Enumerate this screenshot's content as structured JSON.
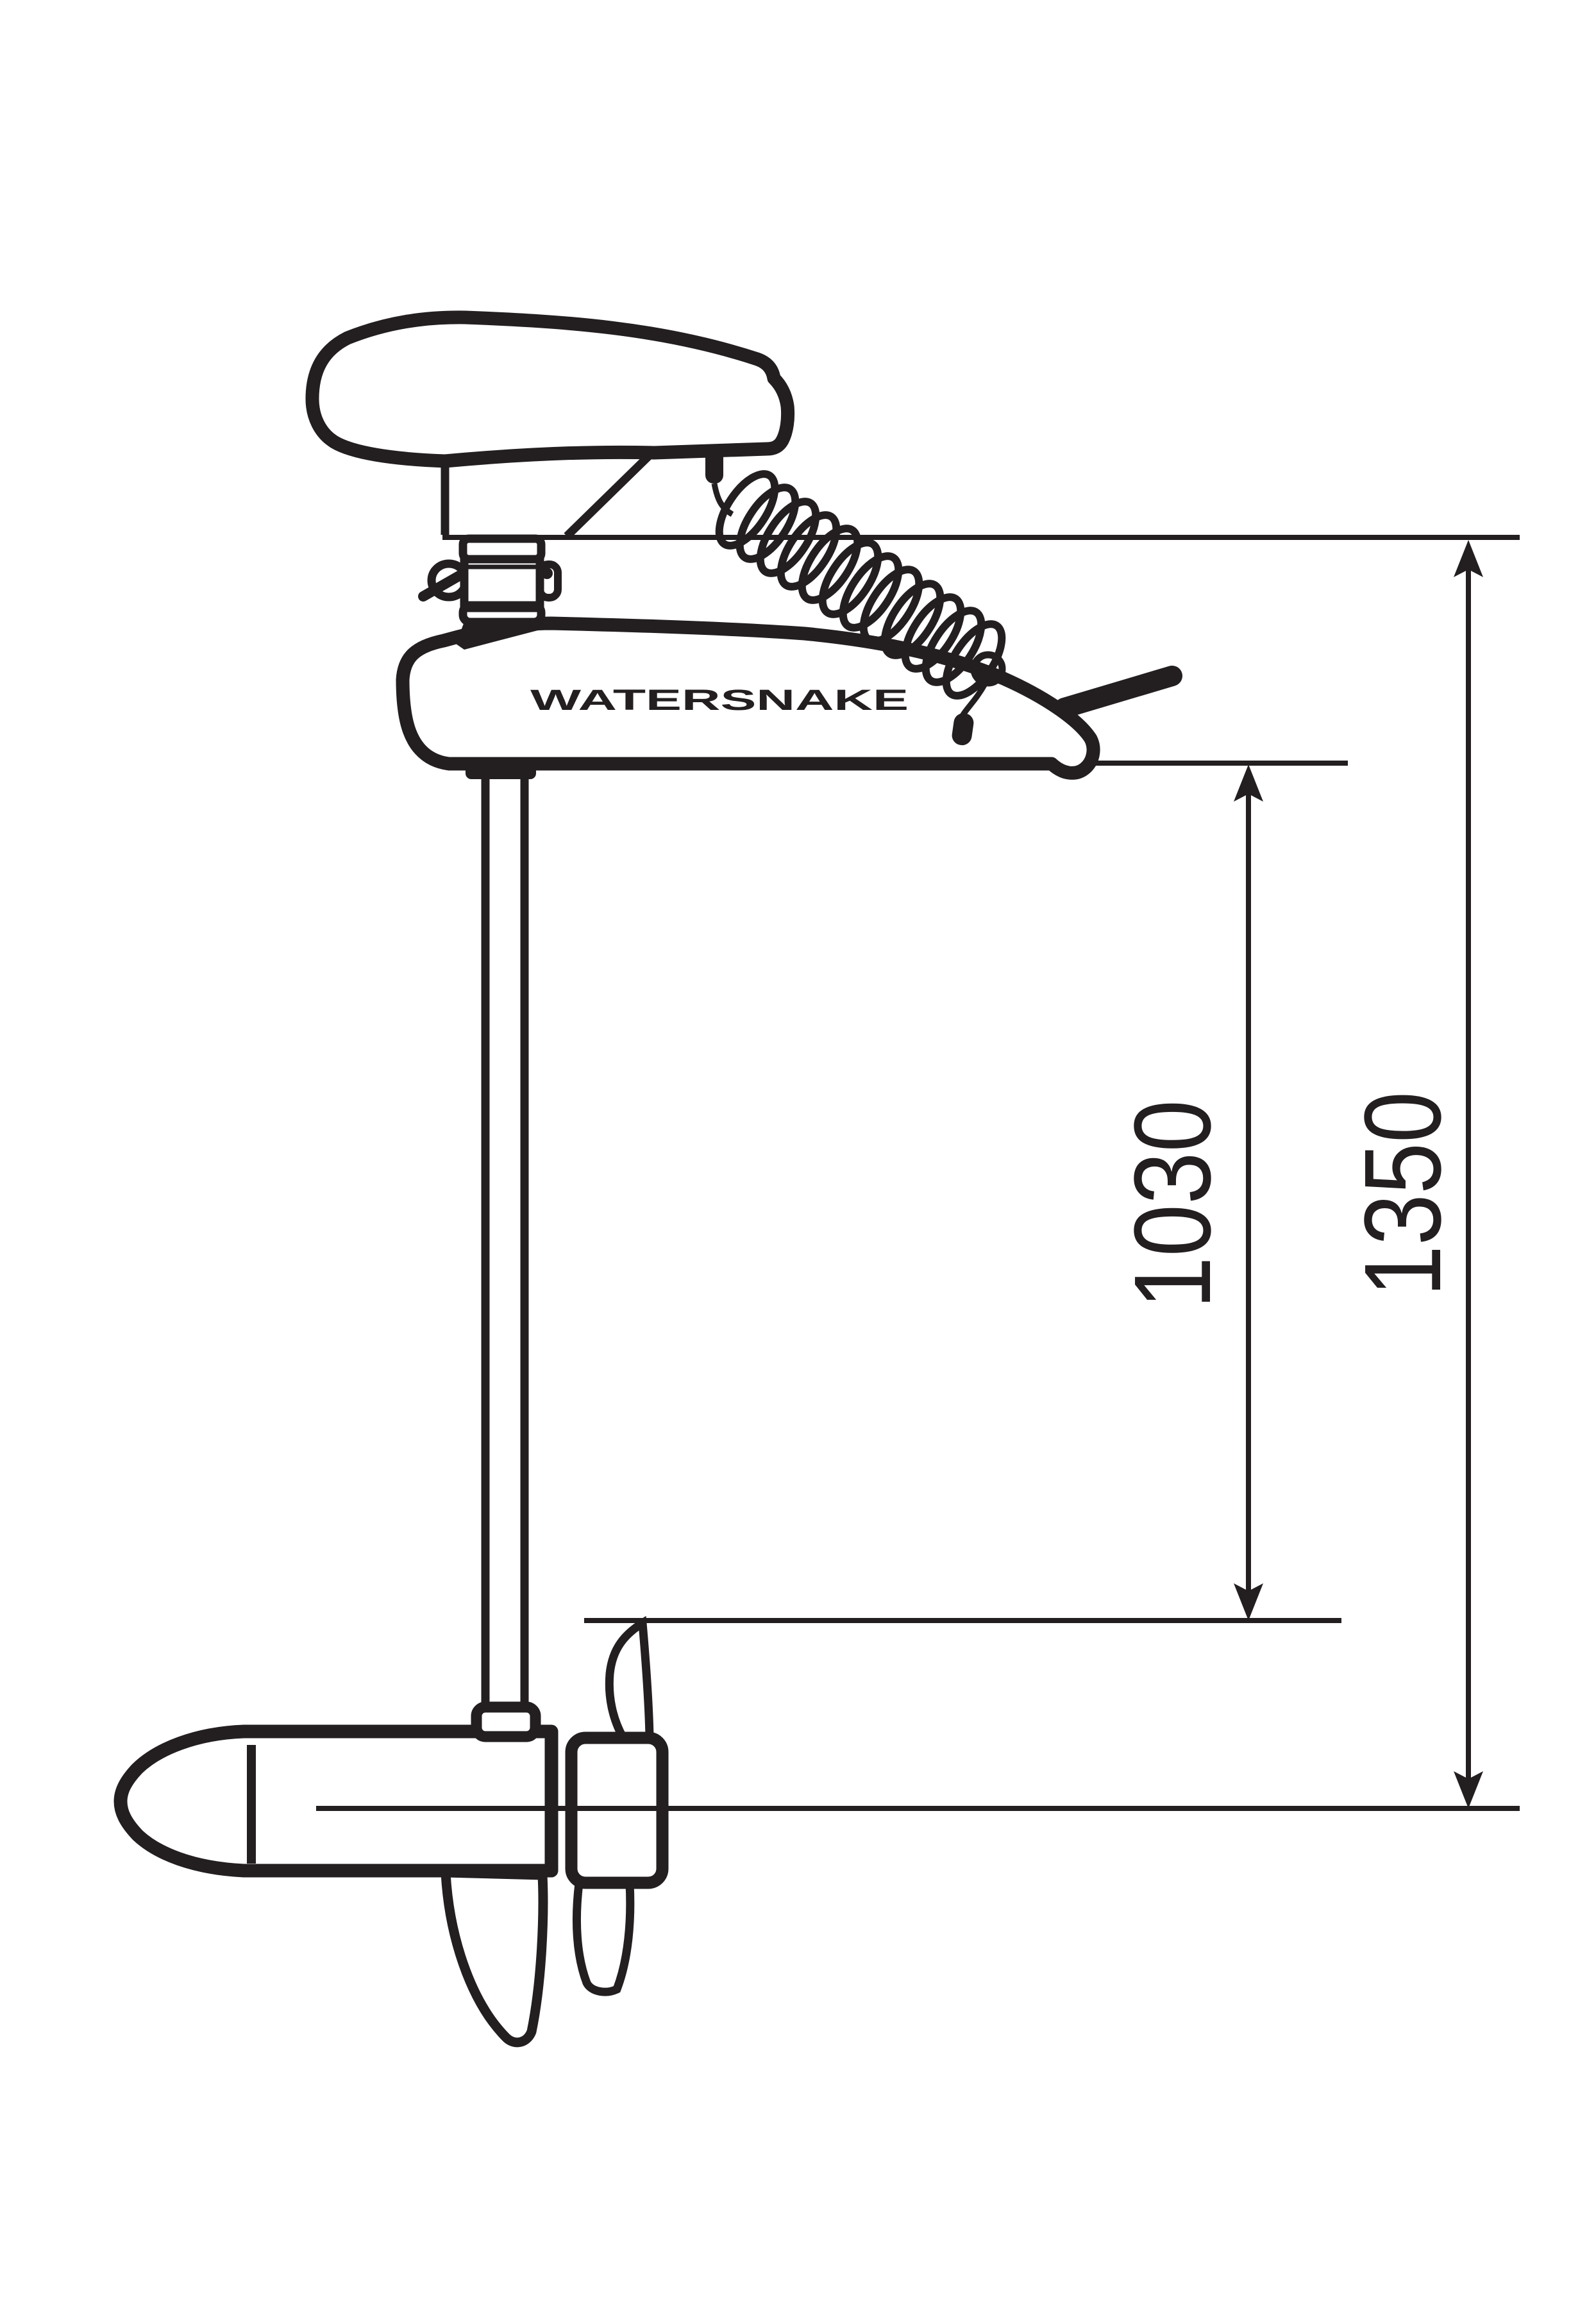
{
  "page": {
    "background": "#ffffff"
  },
  "drawing": {
    "type": "technical-dimension-drawing",
    "subject": "electric trolling motor side view",
    "ink_color": "#231f20",
    "brand_label": "WATERSNAKE",
    "dimensions": {
      "head_base_to_prop_line": "1030",
      "mount_line_to_centerline": "1350"
    }
  }
}
